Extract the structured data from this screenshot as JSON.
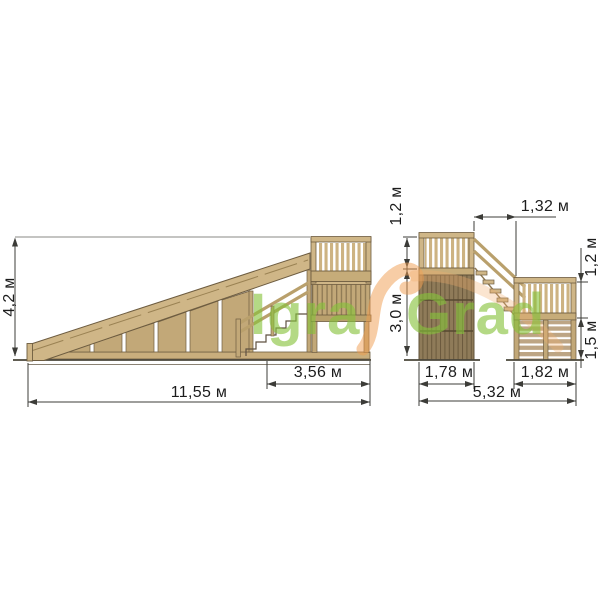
{
  "drawing": {
    "type": "technical-drawing",
    "subject": "wooden slide structure, side view and front view"
  },
  "left_view": {
    "height": "4,2 м",
    "stair_section_width": "3,56 м",
    "total_length": "11,55 м"
  },
  "right_view": {
    "tower_rail_height": "1,2 м",
    "tower_platform_height": "3,0 м",
    "stair_span": "1,32 м",
    "landing_rail_height": "1,2 м",
    "landing_floor_height": "1,5 м",
    "tower_width": "1,78 м",
    "landing_width": "1,82 м",
    "total_width": "5,32 м"
  },
  "watermark": {
    "part1": "Igra",
    "part2": "Grad",
    "green": "#86c23a",
    "orange": "#f09b4e"
  },
  "colors": {
    "wood_light": "#cfb687",
    "wood_mid": "#c2a878",
    "wood_dark": "#8f7b59",
    "outline": "#6d5c40",
    "dimension_line": "#3c3c38",
    "background": "#ffffff"
  }
}
